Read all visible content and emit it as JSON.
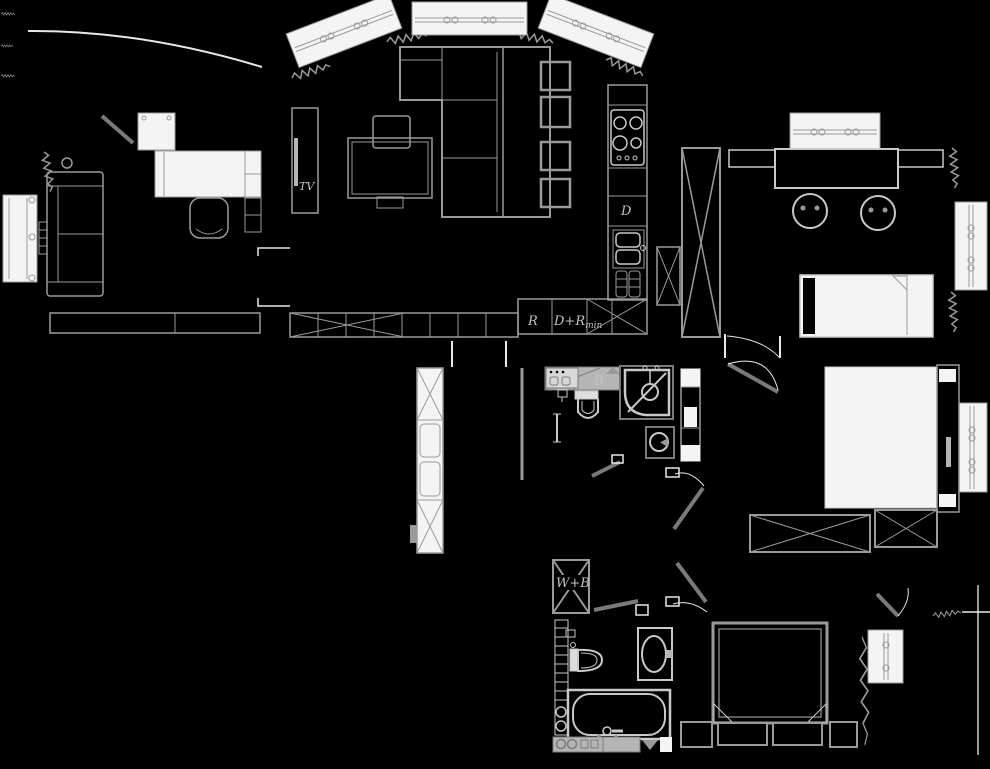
{
  "labels": {
    "tv_cabinet": "TV",
    "kitchen_d": "D",
    "bathroom_b": "B",
    "cabinet_r": "R",
    "cabinet_d_r": "D+R",
    "cabinet_d_r_sub": "min",
    "utility_w_b": "W+B"
  },
  "colors": {
    "bg": "#000000",
    "wall": "#e8e8e8",
    "furn": "#9a9a9a",
    "fix": "#c9c9c9",
    "paper": "#f4f4f4",
    "label": "#c4c4c4",
    "gray": "#b5b5b5"
  }
}
